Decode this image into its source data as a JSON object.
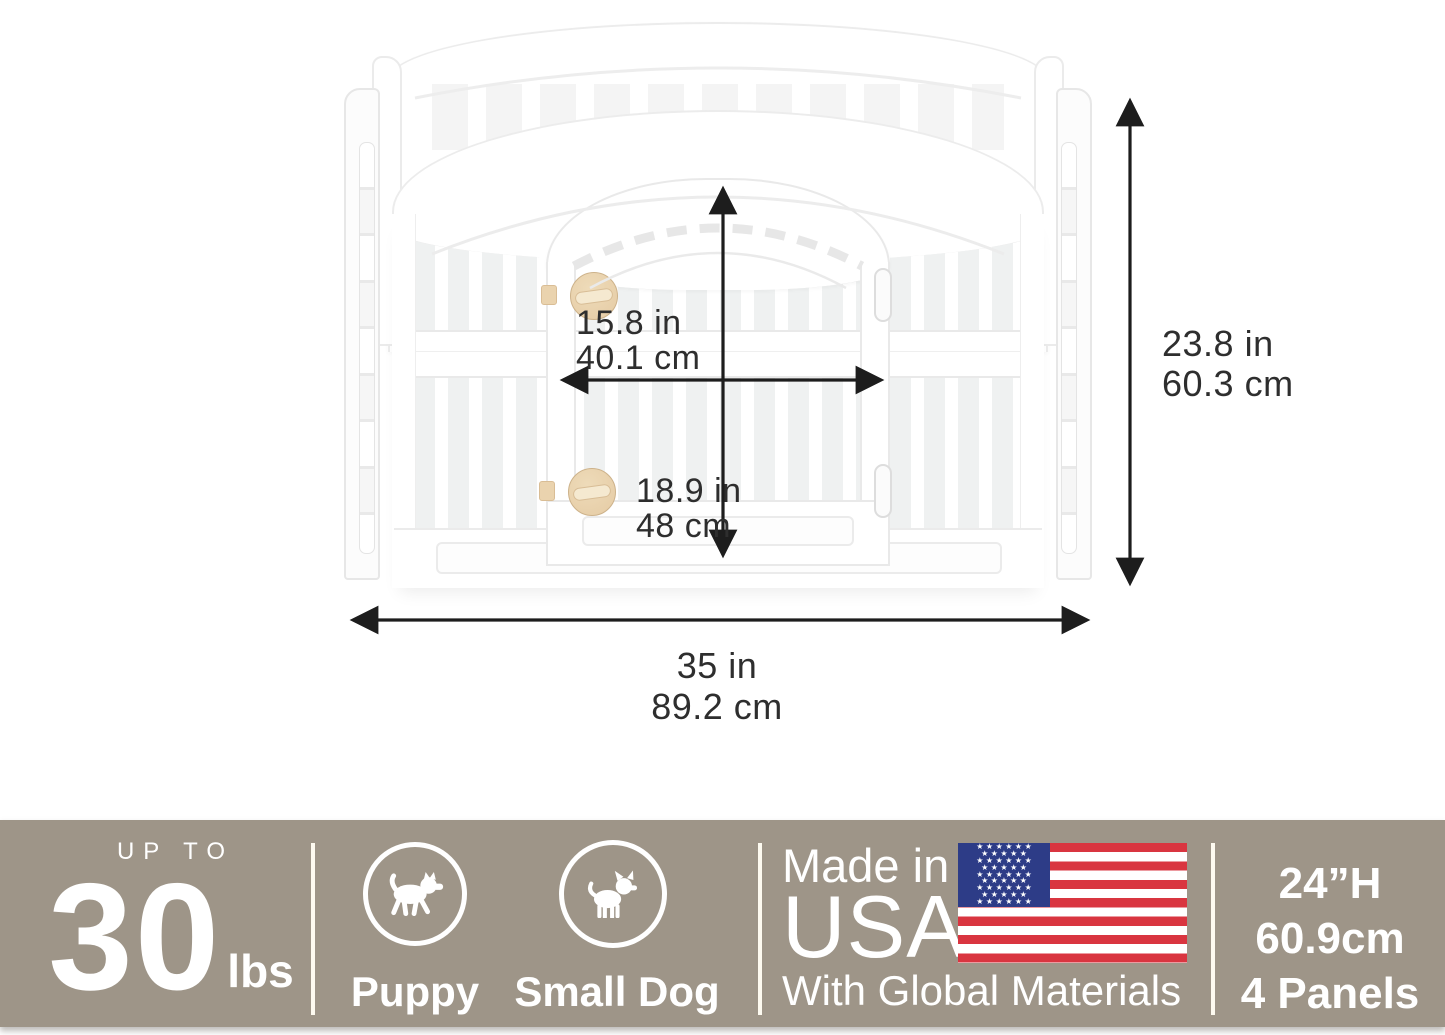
{
  "diagram": {
    "door_width": {
      "inches": "15.8 in",
      "metric": "40.1 cm"
    },
    "door_height": {
      "inches": "18.9 in",
      "metric": "48 cm"
    },
    "pen_height": {
      "inches": "23.8 in",
      "metric": "60.3 cm"
    },
    "pen_width": {
      "inches": "35 in",
      "metric": "89.2 cm"
    }
  },
  "product": {
    "panel_color": "#ffffff",
    "knob_color": "#e5cba4"
  },
  "banner": {
    "weight_limit": {
      "prefix": "UP TO",
      "value": "30",
      "unit": "lbs"
    },
    "pet_types": [
      {
        "label": "Puppy"
      },
      {
        "label": "Small Dog"
      }
    ],
    "made_in": {
      "line1": "Made in",
      "line2": "USA",
      "line3": "With Global Materials"
    },
    "specs": [
      "24”H",
      "60.9cm",
      "4 Panels"
    ],
    "flag_star_rows": [
      6,
      5,
      6,
      5,
      6,
      5,
      6,
      5,
      6
    ],
    "colors": {
      "background": "#9e9588",
      "text": "#ffffff",
      "flag_red": "#d93540",
      "flag_blue": "#2d3c87"
    }
  }
}
